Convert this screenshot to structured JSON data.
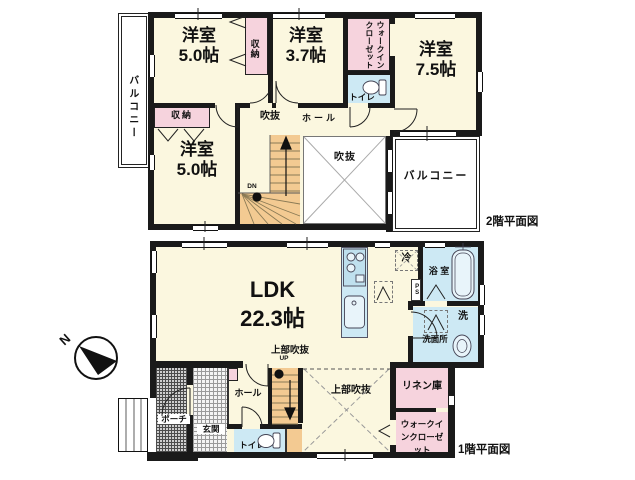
{
  "compass": {
    "north_label": "N"
  },
  "colors": {
    "wall": "#1a1a1a",
    "room_cream": "#FBF7DF",
    "closet_pink": "#F6D3DD",
    "water_blue": "#CDE9F4",
    "stair_tan": "#F3CA92"
  },
  "floor2": {
    "plan_label": "2階平面図",
    "balcony_west": "バルコニー",
    "balcony_east": "バルコニー",
    "room_nw": {
      "name": "洋室",
      "size": "5.0帖"
    },
    "closet_top": "収納",
    "room_n": {
      "name": "洋室",
      "size": "3.7帖"
    },
    "walkin_closet": "ウォークインクローゼット",
    "toilet": "トイレ",
    "room_ne": {
      "name": "洋室",
      "size": "7.5帖"
    },
    "closet_west": "収納",
    "room_sw": {
      "name": "洋室",
      "size": "5.0帖"
    },
    "open_ceiling_hall": "吹抜",
    "hall": "ホール",
    "open_ceiling_void": "吹抜",
    "stairs_down": "DN"
  },
  "floor1": {
    "plan_label": "1階平面図",
    "ldk": {
      "name": "LDK",
      "size": "22.3帖"
    },
    "refrigerator": "冷",
    "bathroom": "浴 室",
    "pipe_space": "PS",
    "laundry": "洗",
    "washroom": "洗面所",
    "linen_closet": "リネン庫",
    "walkin_closet": "ウォークインクローゼット",
    "void_above_left": "上部吹抜",
    "void_above_right": "上部吹抜",
    "stairs_up": "UP",
    "hall": "ホール",
    "toilet": "トイレ",
    "entrance": "玄関",
    "porch": "ポーチ"
  }
}
